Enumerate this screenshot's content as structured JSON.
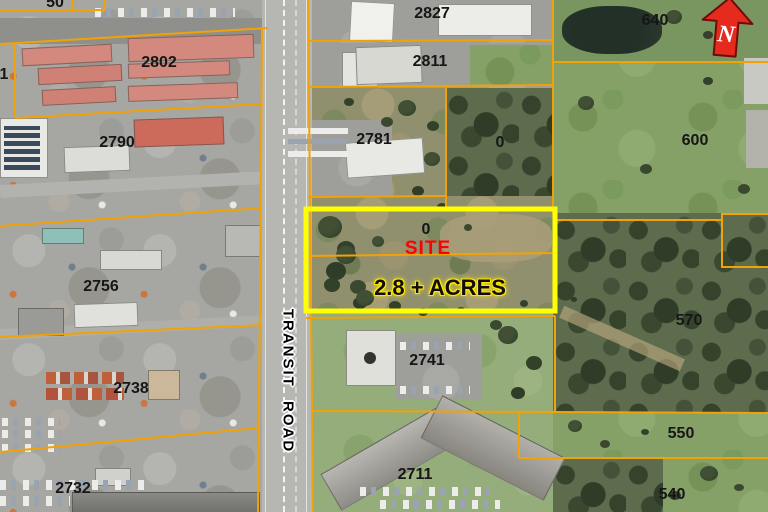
{
  "map": {
    "north_label": "N",
    "road_label": "TRANSIT ROAD",
    "site": {
      "parcel_number": "0",
      "label": "SITE",
      "area_label": "2.8 + ACRES"
    },
    "parcels": [
      {
        "label": "50"
      },
      {
        "label": "1"
      },
      {
        "label": "2802"
      },
      {
        "label": "2790"
      },
      {
        "label": "2756"
      },
      {
        "label": "2738"
      },
      {
        "label": "2732"
      },
      {
        "label": "2827"
      },
      {
        "label": "2811"
      },
      {
        "label": "2781"
      },
      {
        "label": "0"
      },
      {
        "label": "2741"
      },
      {
        "label": "2711"
      },
      {
        "label": "640"
      },
      {
        "label": "600"
      },
      {
        "label": "570"
      },
      {
        "label": "550"
      },
      {
        "label": "540"
      }
    ],
    "colors": {
      "parcel_line": "#F2A206",
      "site_boundary": "#FFFF00",
      "site_label_text": "#FF0000",
      "area_label_text": "#111111",
      "area_label_halo": "#FFE800",
      "north_arrow_fill": "#E62B1E",
      "north_arrow_text": "#FFFFFF"
    }
  }
}
